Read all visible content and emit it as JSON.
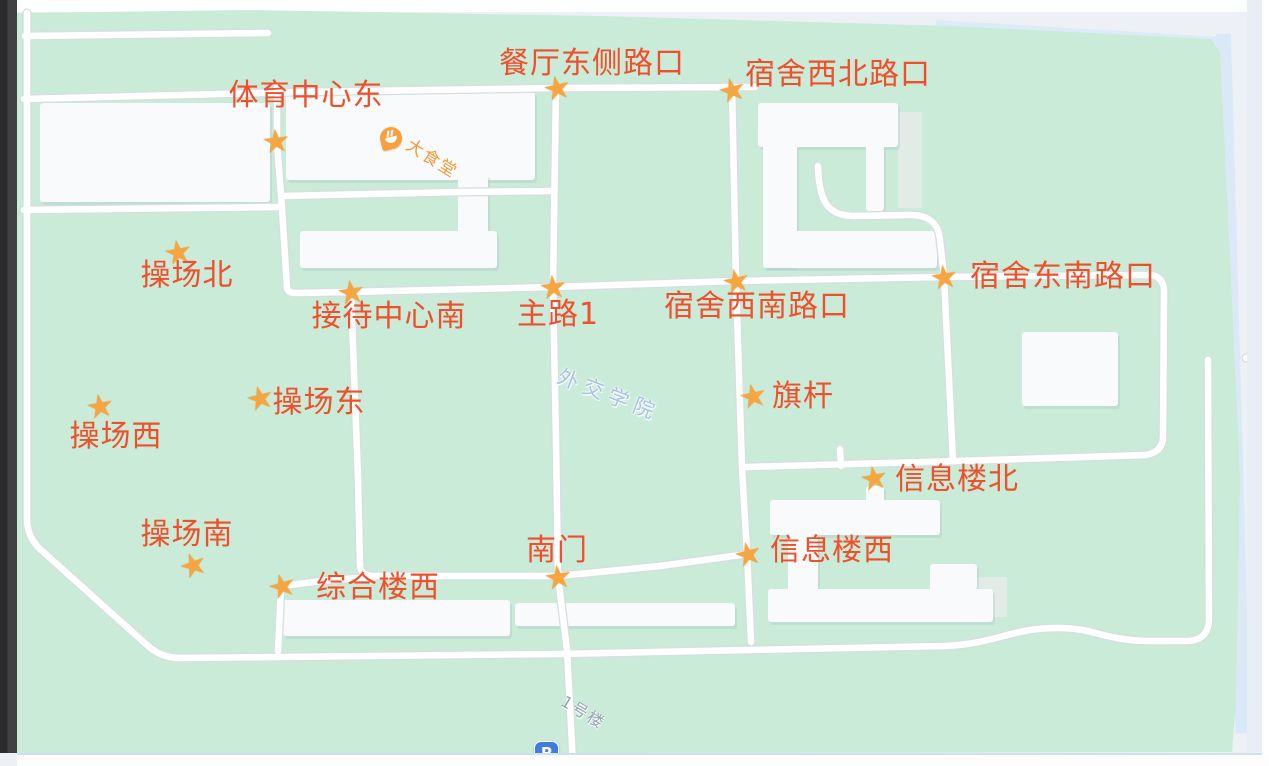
{
  "map": {
    "colors": {
      "campus_green": "#c9ebd8",
      "road_white": "#ffffff",
      "marker_label_red": "#ef4f2a",
      "star_orange": "#f6a640",
      "canteen_poi_orange": "#f0993e",
      "campus_name_blue": "#a6c3e6",
      "building_label_gray": "#97a3b0",
      "parking_blue": "#3f7ce0",
      "water_blue": "#d9e9f7"
    },
    "markers": [
      {
        "label": "体育中心东",
        "x": 276,
        "y": 141,
        "lx": 306,
        "ly": 96,
        "rot": -6
      },
      {
        "label": "餐厅东侧路口",
        "x": 557,
        "y": 88,
        "lx": 592,
        "ly": 64,
        "rot": -12
      },
      {
        "label": "宿舍西北路口",
        "x": 732,
        "y": 90,
        "lx": 838,
        "ly": 75,
        "rot": -14
      },
      {
        "label": "操场北",
        "x": 178,
        "y": 252,
        "lx": 187,
        "ly": 276,
        "rot": -10
      },
      {
        "label": "接待中心南",
        "x": 351,
        "y": 292,
        "lx": 389,
        "ly": 317,
        "rot": -8
      },
      {
        "label": "主路1",
        "x": 553,
        "y": 287,
        "lx": 558,
        "ly": 315,
        "rot": -6
      },
      {
        "label": "宿舍西南路口",
        "x": 736,
        "y": 281,
        "lx": 757,
        "ly": 307,
        "rot": -12
      },
      {
        "label": "宿舍东南路口",
        "x": 944,
        "y": 277,
        "lx": 1063,
        "ly": 277,
        "rot": -8
      },
      {
        "label": "操场东",
        "x": 260,
        "y": 398,
        "lx": 319,
        "ly": 403,
        "rot": -14
      },
      {
        "label": "操场西",
        "x": 100,
        "y": 406,
        "lx": 116,
        "ly": 437,
        "rot": -10
      },
      {
        "label": "旗杆",
        "x": 753,
        "y": 396,
        "lx": 803,
        "ly": 397,
        "rot": -12
      },
      {
        "label": "信息楼北",
        "x": 874,
        "y": 478,
        "lx": 957,
        "ly": 480,
        "rot": -10
      },
      {
        "label": "操场南",
        "x": 193,
        "y": 565,
        "lx": 187,
        "ly": 535,
        "rot": -20
      },
      {
        "label": "南门",
        "x": 558,
        "y": 577,
        "lx": 557,
        "ly": 551,
        "rot": -8
      },
      {
        "label": "信息楼西",
        "x": 748,
        "y": 554,
        "lx": 832,
        "ly": 551,
        "rot": -14
      },
      {
        "label": "综合楼西",
        "x": 282,
        "y": 586,
        "lx": 378,
        "ly": 588,
        "rot": -16
      }
    ],
    "pois": {
      "canteen": {
        "name": "大食堂"
      },
      "campus": {
        "name": "外交学院"
      },
      "building1": {
        "name": "1号楼"
      },
      "parking": {
        "symbol": "P"
      }
    }
  }
}
